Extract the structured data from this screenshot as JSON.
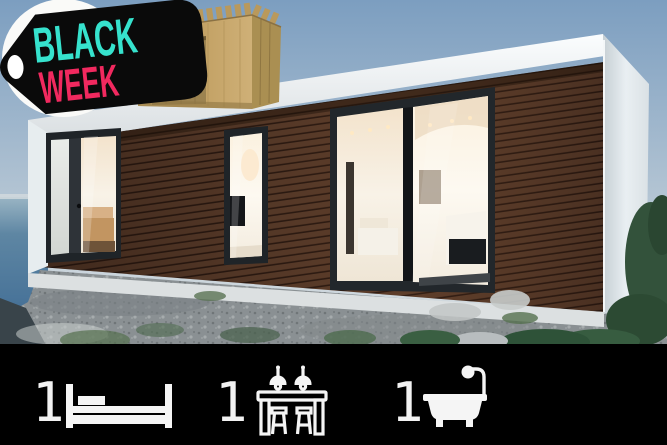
{
  "badge": {
    "line1": "BLACK",
    "line2": "WEEK",
    "colors": {
      "line1": "#36E2CD",
      "line2": "#F1295F",
      "tag_bg": "#0A0A0A",
      "sticker": "#FAFAF8"
    }
  },
  "photo": {
    "alt": "Modern prefab house with dark timber slat facade, floor-to-ceiling glass doors showing warm lit interior, white flat roof, gravel yard, green bushes and ocean view; plywood model crate graphic in the top corner"
  },
  "stats": {
    "bar_color": "#000000",
    "items": [
      {
        "count": "1",
        "icon": "bed-icon"
      },
      {
        "count": "1",
        "icon": "kitchen-icon"
      },
      {
        "count": "1",
        "icon": "bathtub-icon"
      }
    ]
  }
}
